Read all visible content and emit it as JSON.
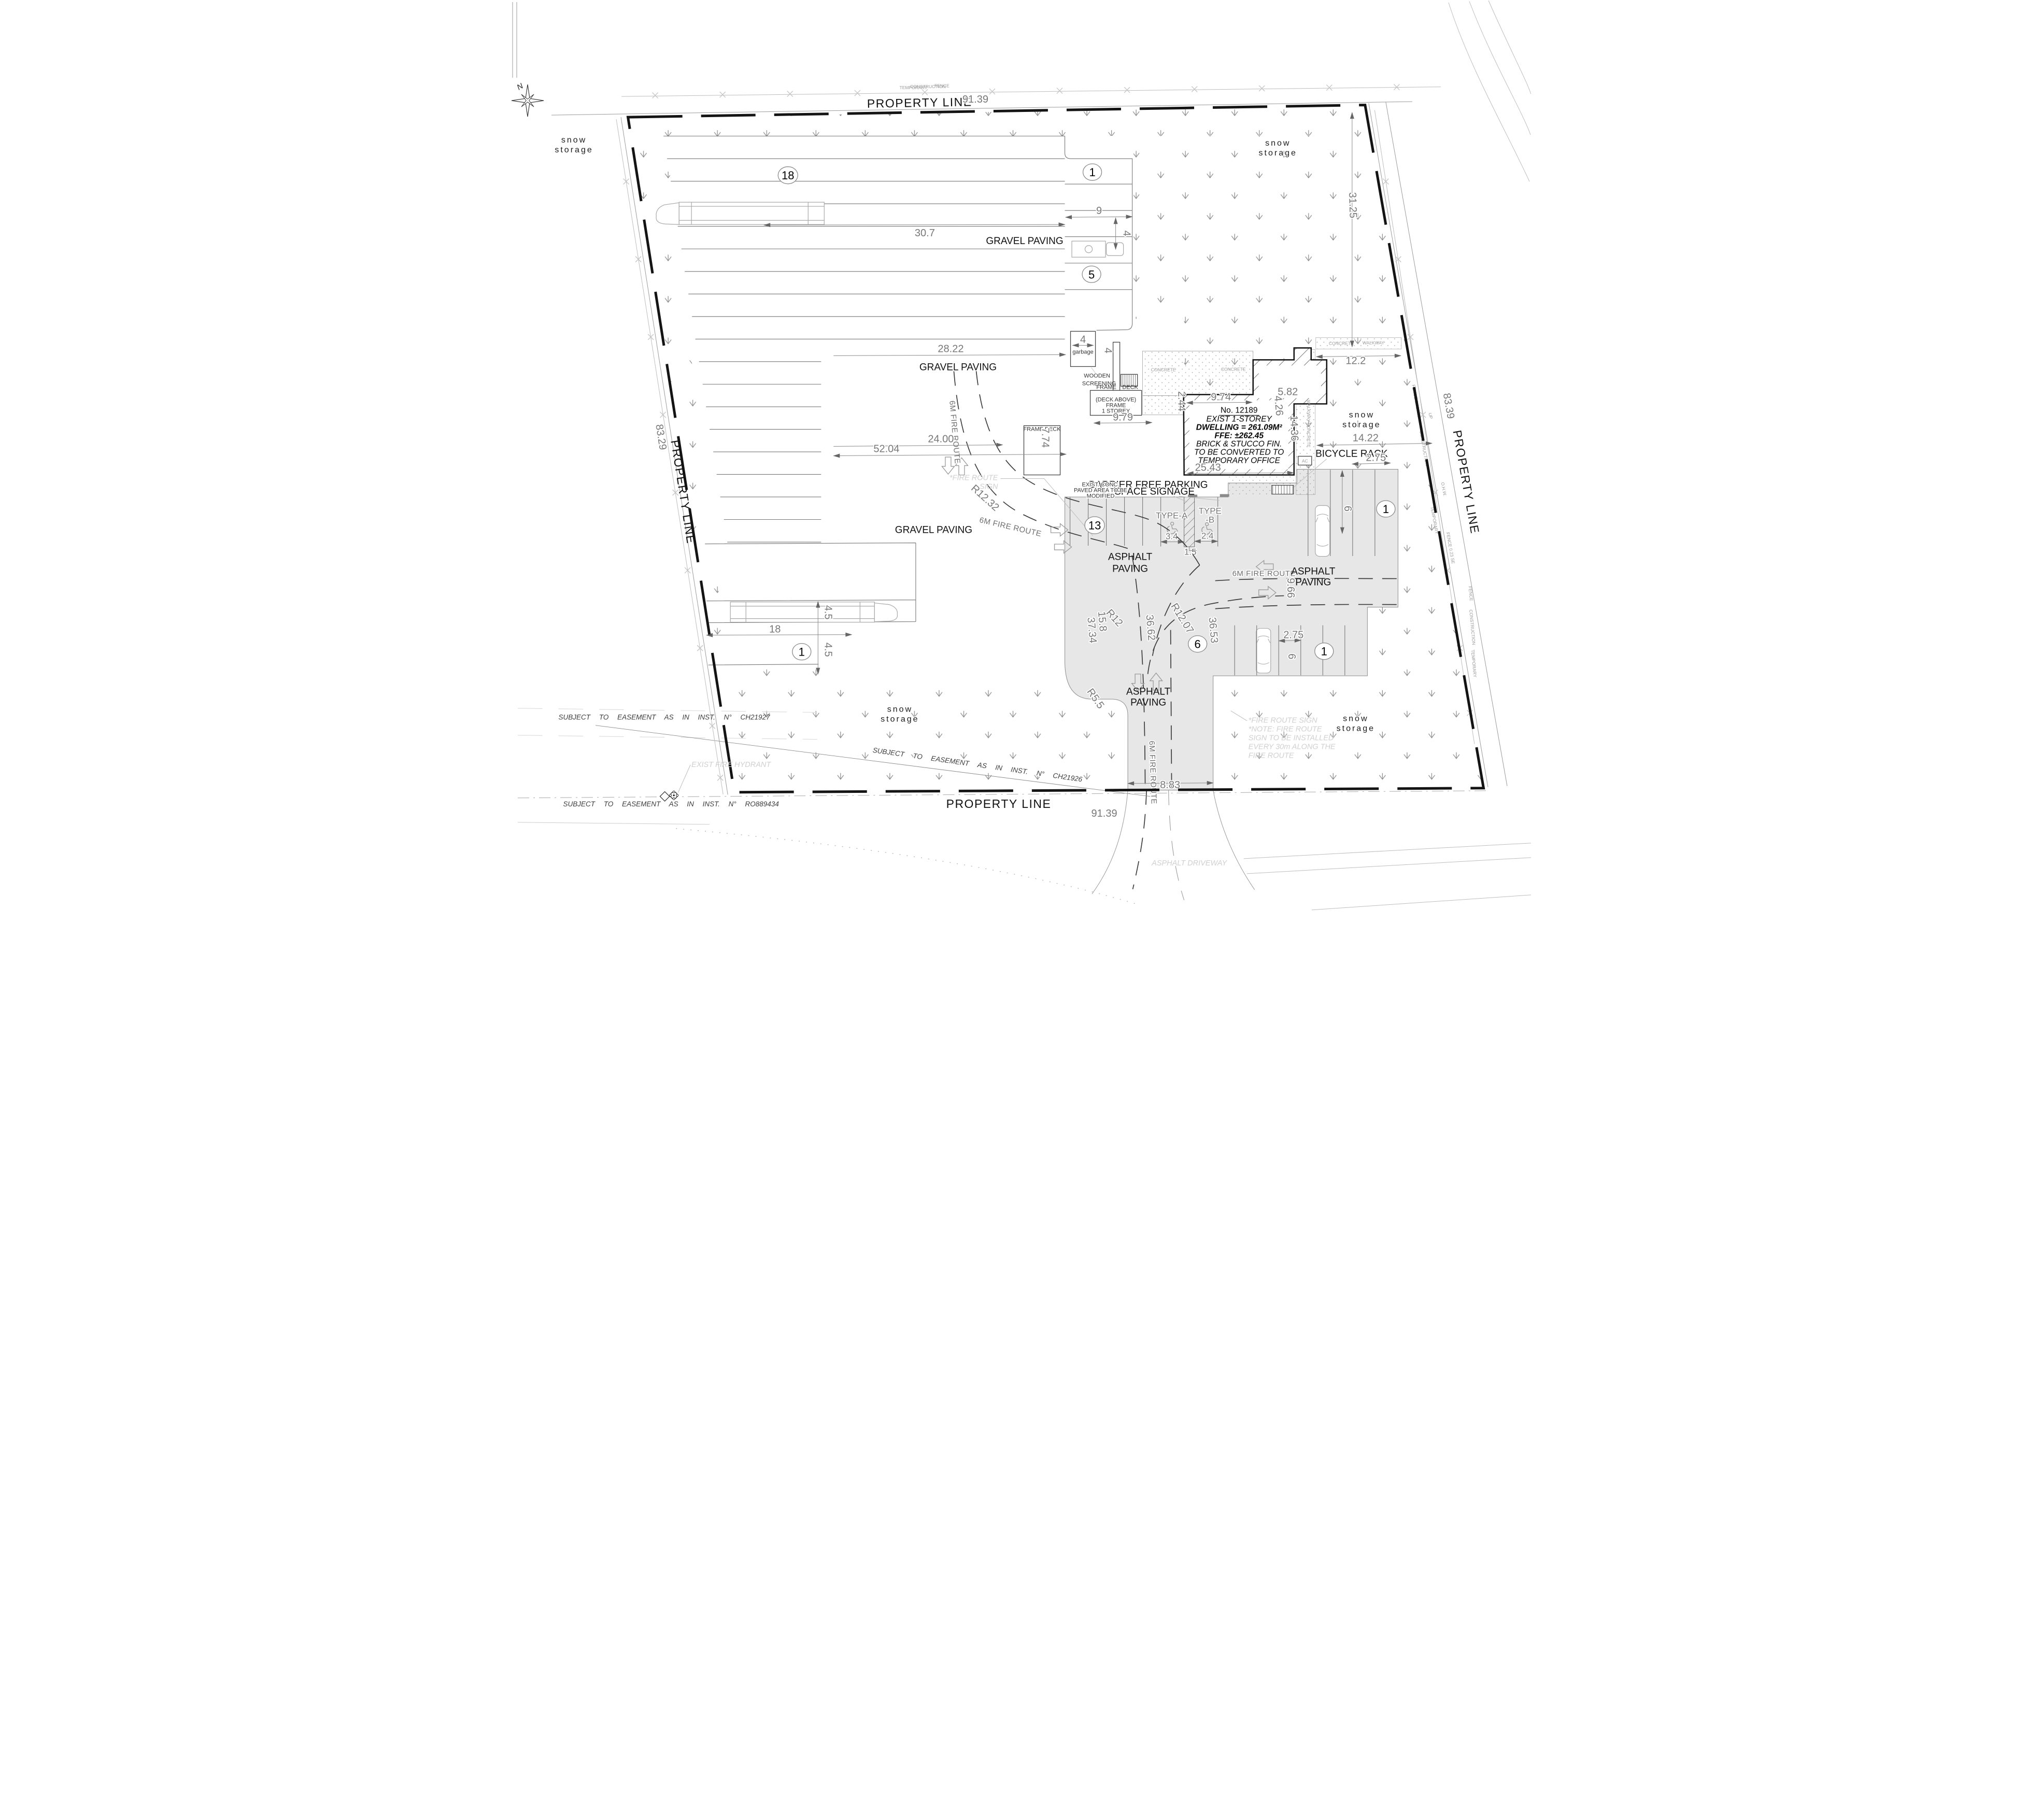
{
  "plan": {
    "property": {
      "label": "PROPERTY LINE",
      "top_len": "91.39",
      "bottom_len": "91.39",
      "left_len": "83.29",
      "right_len": "83.39",
      "right_offset": "31.25"
    },
    "areas": {
      "snow1": "snow",
      "snow2": "storage",
      "gravel": "GRAVEL PAVING",
      "asphalt1": "ASPHALT",
      "asphalt2": "PAVING"
    },
    "routes": {
      "fire": "6M FIRE ROUTE",
      "sign1": "*FIRE ROUTE",
      "sign2": "SIGN",
      "note1": "*FIRE ROUTE SIGN",
      "note2": "*NOTE: FIRE ROUTE",
      "note3": "SIGN TO BE INSTALLED",
      "note4": "EVERY 30m ALONG THE",
      "note5": "FIRE ROUTE"
    },
    "parking": {
      "barrier1": "BARRIER FREE PARKING",
      "barrier2": "SPACE SIGNAGE",
      "type_a": "TYPE-A",
      "type_b1": "TYPE",
      "type_b2": "-B",
      "bike": "BICYCLE RACK",
      "conc1": "EXIST. CONC.",
      "conc2": "PAVED AREA TO BE",
      "conc3": "MODIFIED",
      "counts": {
        "c18": "18",
        "c1": "1",
        "c5": "5",
        "c13": "13",
        "c6": "6"
      }
    },
    "building": {
      "line1": "No. 12189",
      "line2": "EXIST 1-STOREY",
      "line3": "DWELLING = 261.09M²",
      "line4": "FFE: ±262.45",
      "line5": "BRICK & STUCCO FIN.",
      "line6": "TO BE CONVERTED TO",
      "line7": "TEMPORARY OFFICE",
      "deck1": "(DECK ABOVE)",
      "deck2": "FRAME",
      "deck3": "1 STOREY",
      "frame": "FRAME",
      "deck": "DECK",
      "frame_deck": "FRAME DECK",
      "garbage": "garbage",
      "wood1": "WOODEN",
      "wood2": "SCREENING",
      "concrete": "CONCRETE",
      "walkway": "WALKWAY",
      "ac": "AC"
    },
    "easements": {
      "e1": "SUBJECT TO EASEMENT AS IN INST. N° CH21927",
      "e2": "SUBJECT TO EASEMENT AS IN INST. N° RO889434",
      "e3": "SUBJECT TO EASEMENT AS IN INST. N° CH21926",
      "hydrant": "EXIST FIRE HYDRANT",
      "driveway": "ASPHALT DRIVEWAY"
    },
    "fence": {
      "temporary": "TEMPORARY",
      "construction": "CONSTRUCTION",
      "fence": "FENCE",
      "f048": "FENCE 0.48 NW",
      "f023": "FENCE 0.23 SE",
      "ohw": "O.H.W.",
      "up": "UP"
    },
    "north": "N",
    "dims": {
      "d30_7": "30.7",
      "d9": "9",
      "d4": "4",
      "d28_22": "28.22",
      "d12_2": "12.2",
      "d5_82": "5.82",
      "d4_26": "4.26",
      "d2_44": "2.44",
      "d9_74": "9.74",
      "d9_79": "9.79",
      "d7_74": "7.74",
      "d14_36": "14.36",
      "d25_43": "25.43",
      "d14_22": "14.22",
      "d2_75": "2.75",
      "d52_04": "52.04",
      "d24_00": "24.00",
      "d3_4": "3.4",
      "d2_4": "2.4",
      "d1_5": "1.5",
      "d6": "6",
      "d9_66": "9.66",
      "d36_53": "36.53",
      "d36_62": "36.62",
      "d37_34": "37.34",
      "d15_8": "15.8",
      "r12": "R12",
      "r12_07": "R12.07",
      "r12_32": "R12.32",
      "r5_5": "R5.5",
      "d8_83": "8.83",
      "d18": "18",
      "d4_5": "4.5"
    },
    "colors": {
      "asphalt": "#e7e7e7",
      "line_heavy": "#141414",
      "dim_text": "#787878",
      "faint_text": "#d0d0d0",
      "grass_mark": "#909090"
    }
  }
}
